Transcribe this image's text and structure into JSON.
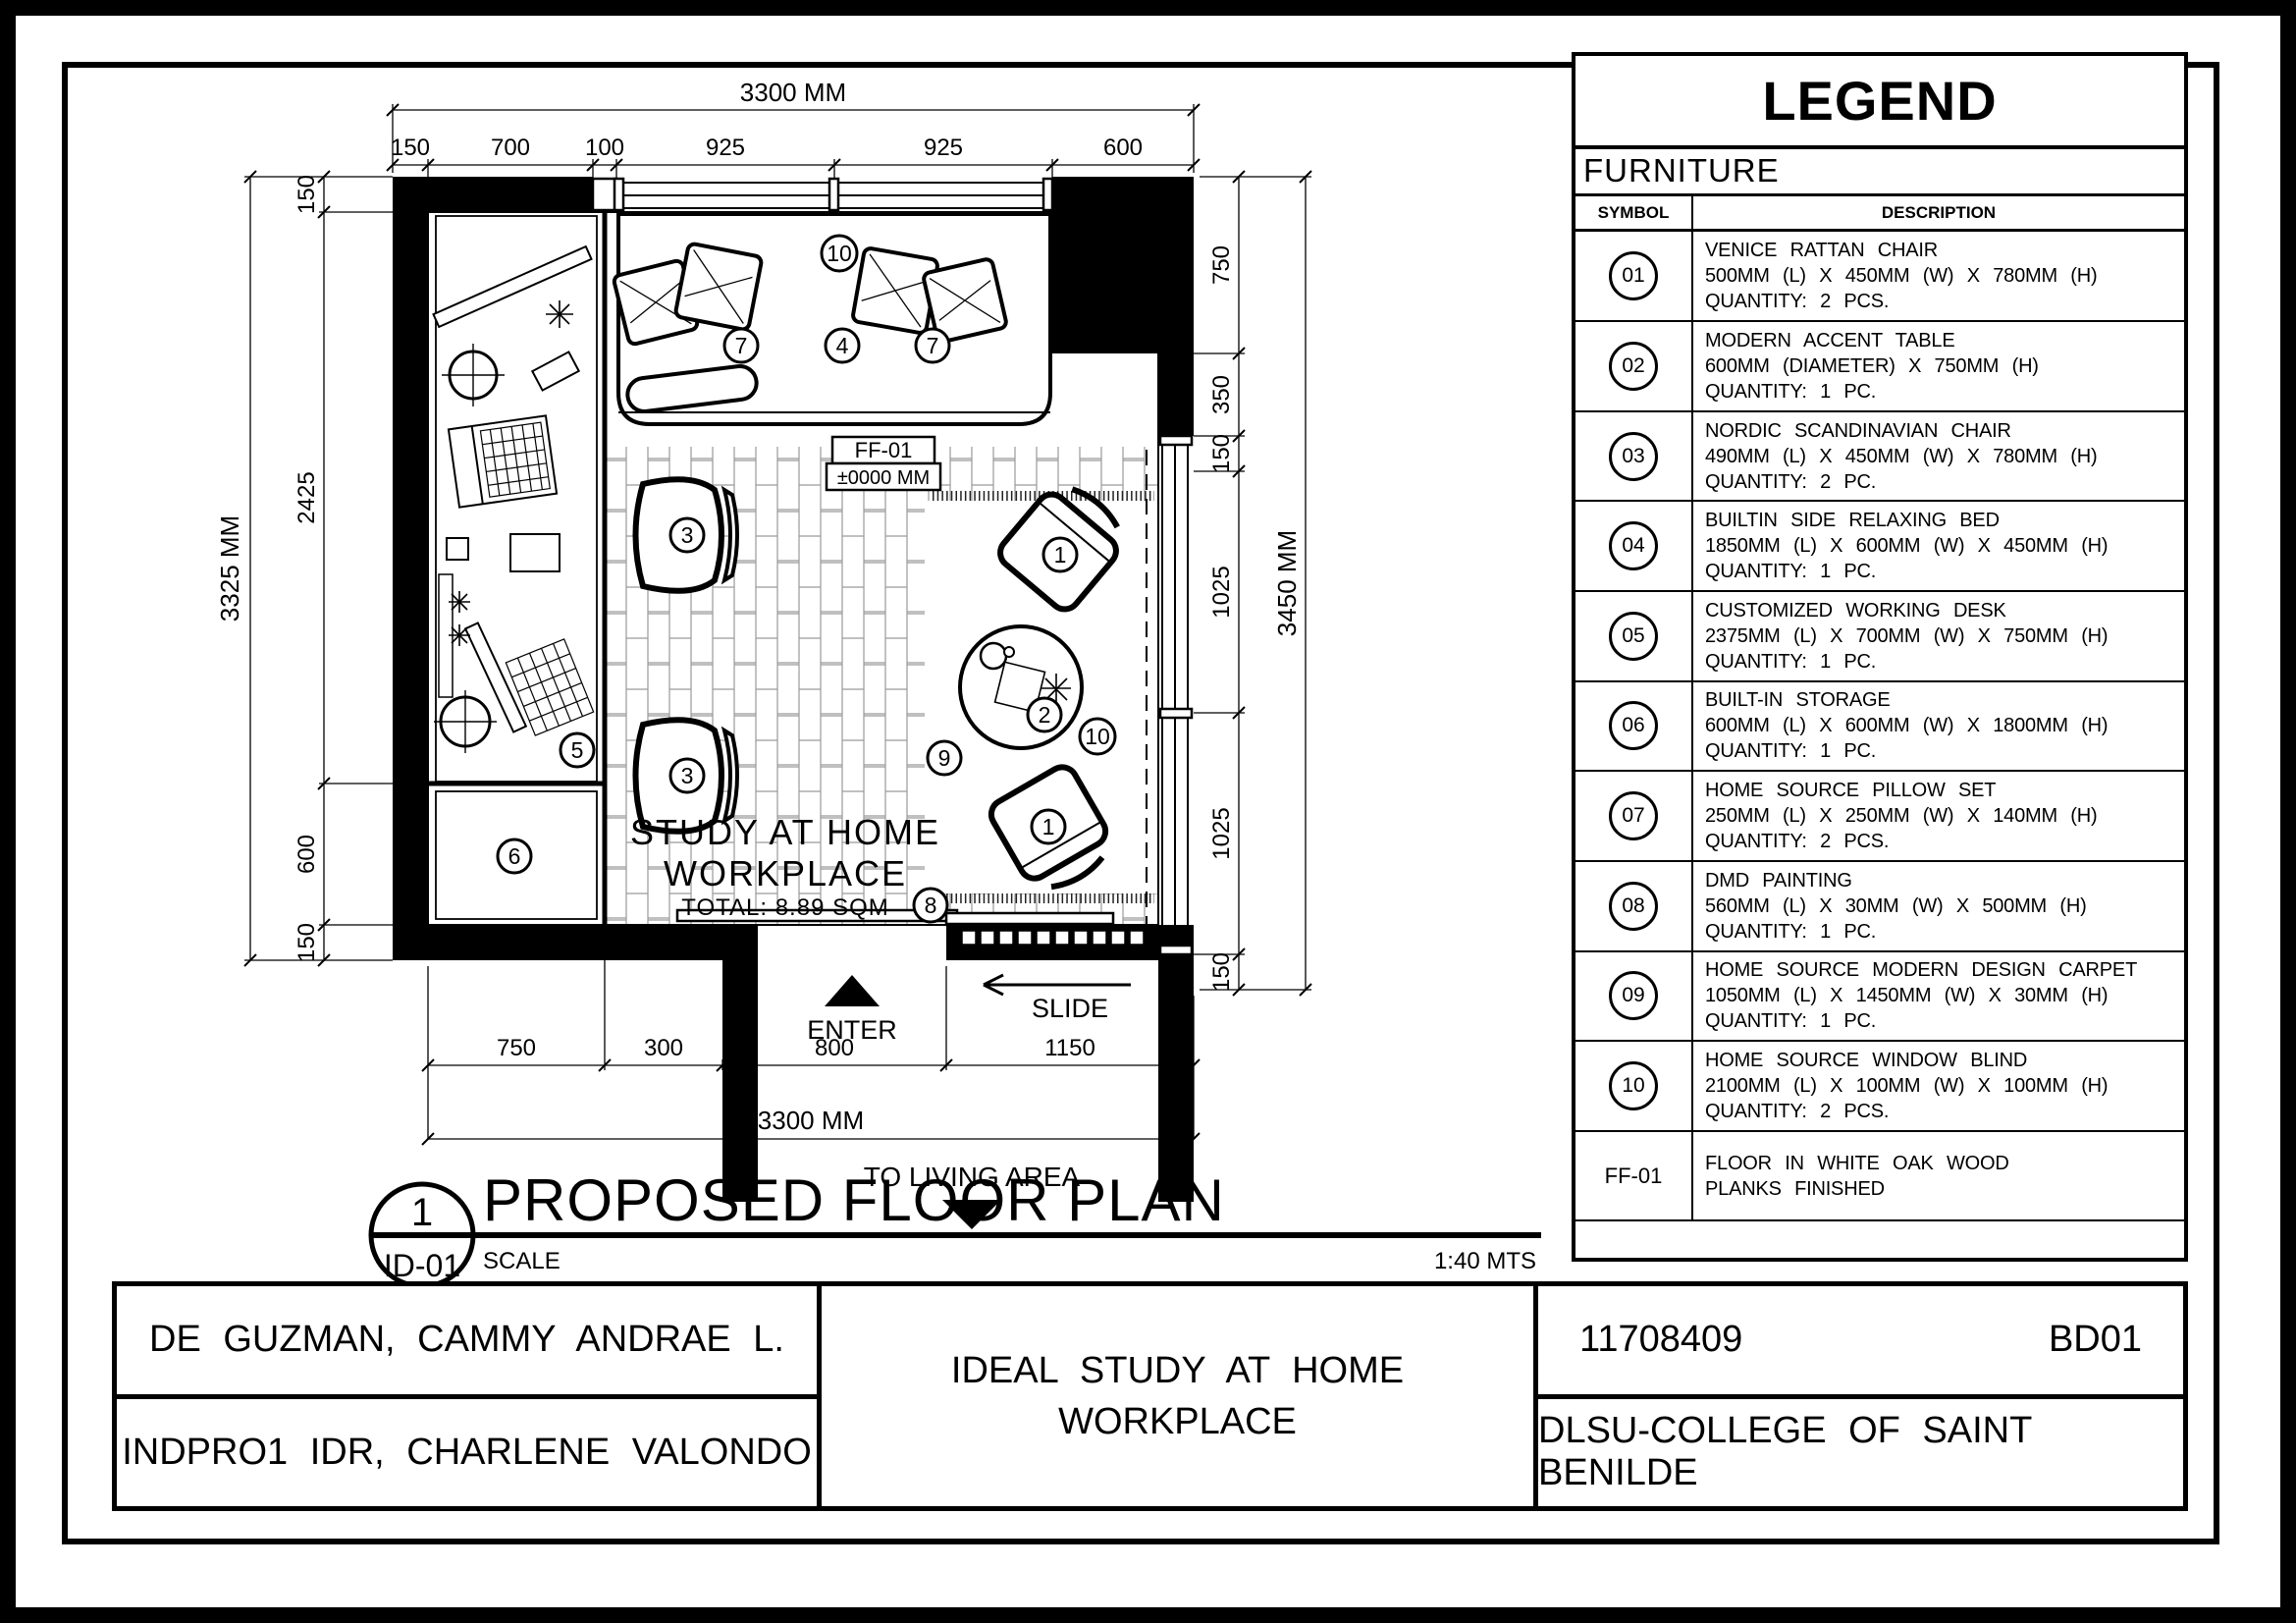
{
  "legend": {
    "title": "LEGEND",
    "category": "FURNITURE",
    "columns": {
      "symbol": "SYMBOL",
      "description": "DESCRIPTION"
    },
    "items": [
      {
        "symbol": "01",
        "name": "VENICE RATTAN CHAIR",
        "dimensions": "500MM (L) X 450MM (W) X 780MM (H)",
        "quantity": "QUANTITY: 2 PCS."
      },
      {
        "symbol": "02",
        "name": "MODERN ACCENT TABLE",
        "dimensions": "600MM (DIAMETER) X 750MM (H)",
        "quantity": "QUANTITY: 1 PC."
      },
      {
        "symbol": "03",
        "name": "NORDIC SCANDINAVIAN CHAIR",
        "dimensions": "490MM (L) X 450MM (W) X 780MM (H)",
        "quantity": "QUANTITY: 2 PC."
      },
      {
        "symbol": "04",
        "name": "BUILTIN SIDE RELAXING BED",
        "dimensions": "1850MM (L) X 600MM (W) X 450MM (H)",
        "quantity": "QUANTITY: 1 PC."
      },
      {
        "symbol": "05",
        "name": "CUSTOMIZED WORKING DESK",
        "dimensions": "2375MM (L) X 700MM (W) X 750MM (H)",
        "quantity": "QUANTITY: 1 PC."
      },
      {
        "symbol": "06",
        "name": "BUILT-IN STORAGE",
        "dimensions": "600MM (L) X 600MM (W) X 1800MM (H)",
        "quantity": "QUANTITY: 1 PC."
      },
      {
        "symbol": "07",
        "name": "HOME SOURCE PILLOW SET",
        "dimensions": "250MM (L) X 250MM (W) X 140MM (H)",
        "quantity": "QUANTITY: 2 PCS."
      },
      {
        "symbol": "08",
        "name": "DMD PAINTING",
        "dimensions": "560MM (L) X 30MM (W) X 500MM (H)",
        "quantity": "QUANTITY: 1 PC."
      },
      {
        "symbol": "09",
        "name": "HOME SOURCE MODERN DESIGN CARPET",
        "dimensions": "1050MM (L) X 1450MM (W) X 30MM (H)",
        "quantity": "QUANTITY: 1 PC."
      },
      {
        "symbol": "10",
        "name": "HOME SOURCE WINDOW BLIND",
        "dimensions": "2100MM (L) X 100MM (W) X 100MM (H)",
        "quantity": "QUANTITY: 2 PCS."
      }
    ],
    "floor_finish": {
      "symbol": "FF-01",
      "line1": "FLOOR IN WHITE OAK WOOD",
      "line2": "PLANKS FINISHED"
    }
  },
  "plan": {
    "room_label_line1": "STUDY AT HOME",
    "room_label_line2": "WORKPLACE",
    "room_total": "TOTAL: 8.89 SQM",
    "floor_tag": "FF-01",
    "floor_level": "±0000 MM",
    "enter_label": "ENTER",
    "slide_label": "SLIDE",
    "to_living": "TO LIVING AREA",
    "callouts": {
      "n1": "1",
      "n2": "2",
      "n3": "3",
      "n4": "4",
      "n5": "5",
      "n6": "6",
      "n7": "7",
      "n8": "8",
      "n9": "9",
      "n10": "10"
    },
    "dims": {
      "top_overall": "3300 MM",
      "top_segments": [
        "150",
        "700",
        "100",
        "925",
        "925",
        "600"
      ],
      "left_overall": "3325 MM",
      "left_segments": [
        "150",
        "2425",
        "600",
        "150"
      ],
      "right_overall": "3450 MM",
      "right_segments": [
        "750",
        "350",
        "150",
        "1025",
        "1025",
        "150"
      ],
      "bottom_segments": [
        "750",
        "300",
        "800",
        "1150"
      ],
      "bottom_overall": "3300 MM"
    }
  },
  "title": {
    "number": "1",
    "sheet_ref": "ID-01",
    "name": "PROPOSED FLOOR PLAN",
    "scale_label": "SCALE",
    "scale_value": "1:40 MTS"
  },
  "titleblock": {
    "student": "DE GUZMAN, CAMMY ANDRAE L.",
    "course": "INDPRO1 IDR, CHARLENE VALONDO",
    "project_line1": "IDEAL STUDY AT HOME",
    "project_line2": "WORKPLACE",
    "id_number": "11708409",
    "code": "BD01",
    "school": "DLSU-COLLEGE OF SAINT BENILDE"
  }
}
